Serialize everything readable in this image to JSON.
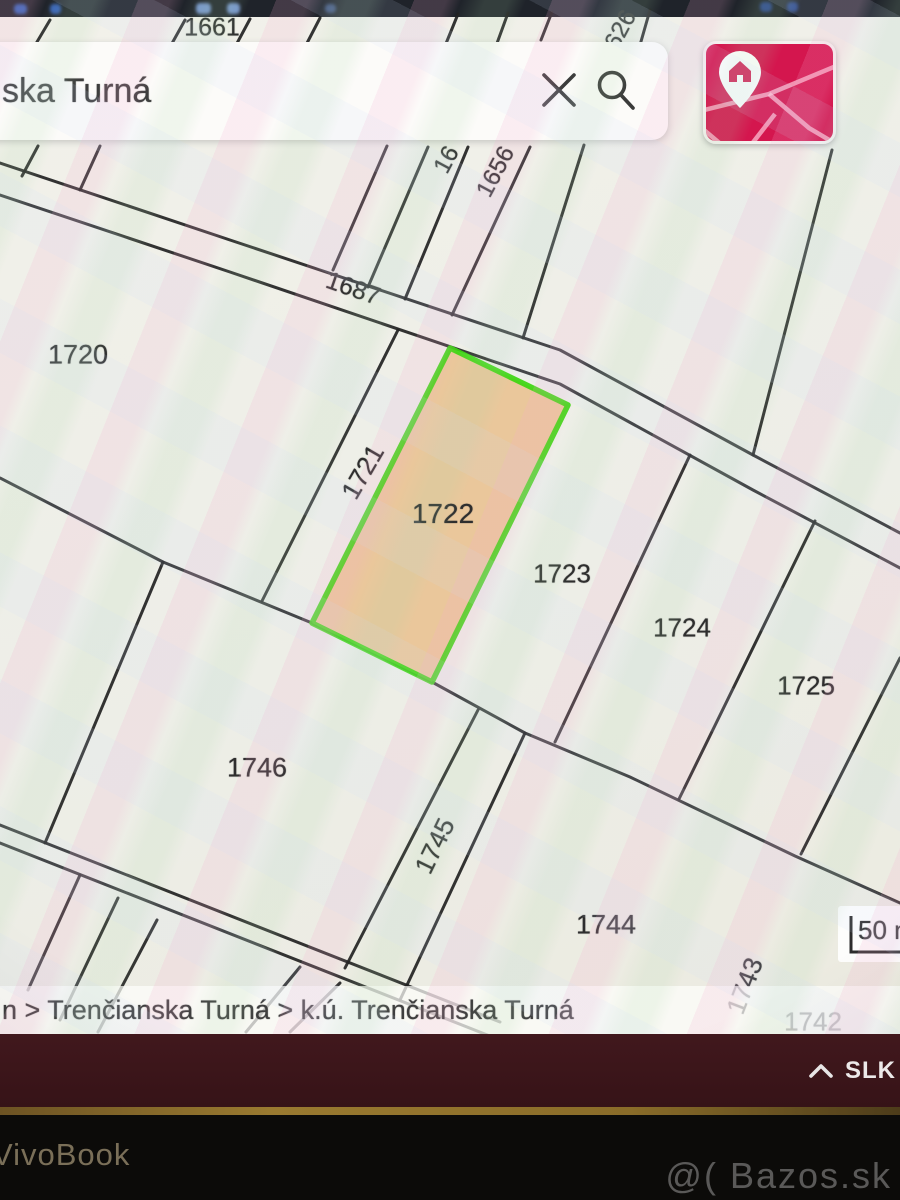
{
  "top_bar": {
    "color": "#1f232a"
  },
  "search": {
    "value": "ska Turná",
    "clear_icon": "x-icon",
    "search_icon": "magnifier-icon"
  },
  "map_button": {
    "color": "#d4164e",
    "icon": "map-with-home-pin"
  },
  "map": {
    "highlight": {
      "id": "1722",
      "fill": "#eac79b",
      "stroke": "#3bd60f"
    },
    "scale": {
      "label": "50 m"
    },
    "parcels": [
      {
        "id": "1661",
        "x": 212,
        "y": 28,
        "rot": 0,
        "size": 25
      },
      {
        "id": "626",
        "x": 621,
        "y": 30,
        "rot": -62,
        "size": 24
      },
      {
        "id": "16",
        "x": 447,
        "y": 160,
        "rot": -62,
        "size": 24
      },
      {
        "id": "1656",
        "x": 496,
        "y": 172,
        "rot": -62,
        "size": 24
      },
      {
        "id": "1687",
        "x": 353,
        "y": 289,
        "rot": 19,
        "size": 25
      },
      {
        "id": "1720",
        "x": 78,
        "y": 355,
        "rot": 0,
        "size": 27
      },
      {
        "id": "1721",
        "x": 363,
        "y": 472,
        "rot": -60,
        "size": 26
      },
      {
        "id": "1722",
        "x": 443,
        "y": 514,
        "rot": 0,
        "size": 28
      },
      {
        "id": "1723",
        "x": 562,
        "y": 574,
        "rot": 0,
        "size": 26
      },
      {
        "id": "1724",
        "x": 682,
        "y": 628,
        "rot": 0,
        "size": 26
      },
      {
        "id": "1725",
        "x": 806,
        "y": 686,
        "rot": 0,
        "size": 26
      },
      {
        "id": "1746",
        "x": 257,
        "y": 768,
        "rot": 0,
        "size": 27
      },
      {
        "id": "1745",
        "x": 435,
        "y": 846,
        "rot": -64,
        "size": 26
      },
      {
        "id": "1744",
        "x": 606,
        "y": 925,
        "rot": 0,
        "size": 27
      },
      {
        "id": "1743",
        "x": 745,
        "y": 986,
        "rot": -69,
        "size": 26
      },
      {
        "id": "1742",
        "x": 813,
        "y": 1022,
        "rot": 0,
        "size": 26
      }
    ]
  },
  "breadcrumb": {
    "text": "n > Trenčianska Turná > k.ú. Trenčianska Turná"
  },
  "system_bar": {
    "language": "SLK",
    "chevron": "chevron-up",
    "color": "#3a151a"
  },
  "bezel": {
    "brand": "VivoBook",
    "watermark": "@( Bazos.sk"
  }
}
